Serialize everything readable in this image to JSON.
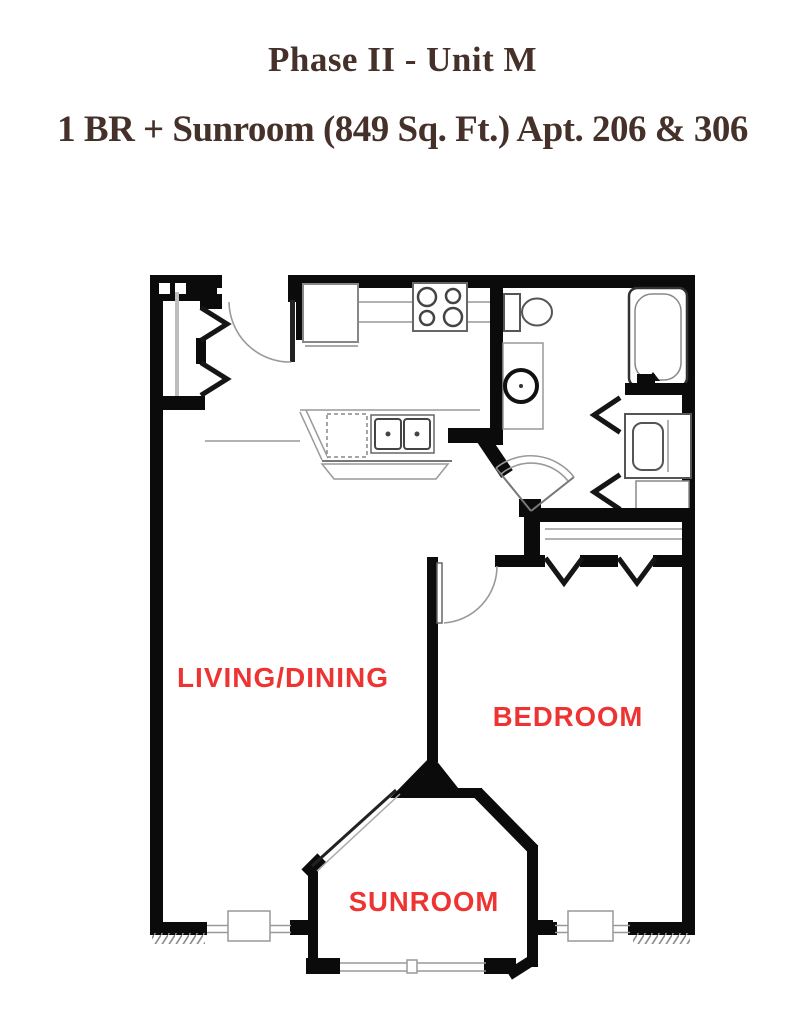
{
  "header": {
    "title_line1": "Phase II - Unit M",
    "title_line2": "1 BR + Sunroom (849 Sq. Ft.) Apt. 206 & 306",
    "title_color": "#45312a"
  },
  "floor_plan": {
    "labels": {
      "living": "LIVING/DINING",
      "bedroom": "BEDROOM",
      "sunroom": "SUNROOM"
    },
    "label_color": "#ee3433",
    "wall_color": "#0b0b0b",
    "fixtures": [
      "entry-door",
      "coat-closet-bifold",
      "refrigerator",
      "range-4-burner",
      "kitchen-double-sink",
      "dishwasher",
      "breakfast-bar",
      "toilet",
      "washer",
      "bathtub",
      "vanity-sink",
      "linen-cabinet",
      "bifold-closet-doors",
      "bedroom-door",
      "bedroom-closet-bifold",
      "window-living",
      "window-bedroom",
      "sunroom-bay-windows"
    ]
  }
}
